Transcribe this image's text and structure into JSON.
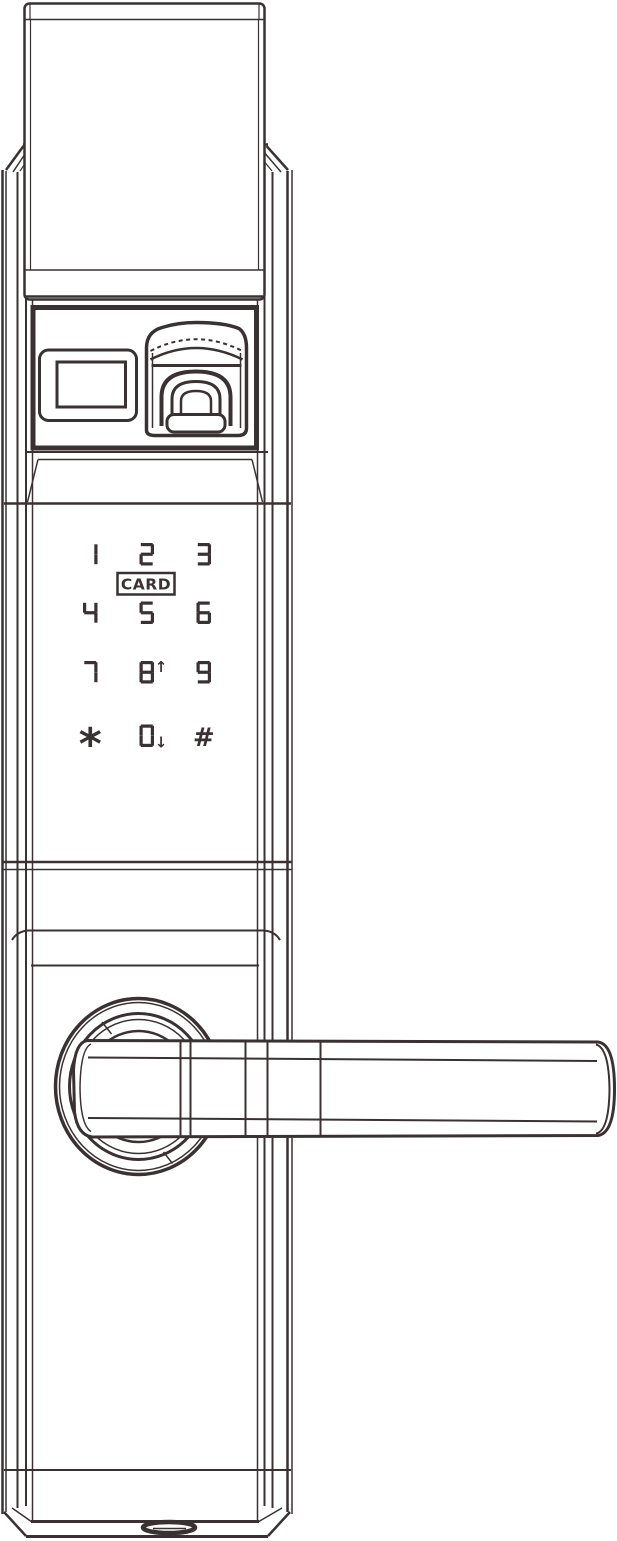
{
  "colors": {
    "line": "#3a3132",
    "background": "#ffffff"
  },
  "card_reader": {
    "label": "CARD"
  },
  "keypad": {
    "keys": [
      {
        "label": "1"
      },
      {
        "label": "2"
      },
      {
        "label": "3"
      },
      {
        "label": "4"
      },
      {
        "label": "5"
      },
      {
        "label": "6"
      },
      {
        "label": "7"
      },
      {
        "label": "8",
        "arrow": "↑"
      },
      {
        "label": "9"
      },
      {
        "label": "*"
      },
      {
        "label": "0",
        "arrow": "↓"
      },
      {
        "label": "#"
      }
    ]
  },
  "parts": {
    "top_cover": "top-cover",
    "display_window": "display-window",
    "fingerprint_reader": "fingerprint-reader",
    "card_reader": "card-reader-badge",
    "keypad": "touch-keypad",
    "handle": "door-handle-lever",
    "rosette": "handle-rosette",
    "usb_port": "usb-port-slot"
  }
}
